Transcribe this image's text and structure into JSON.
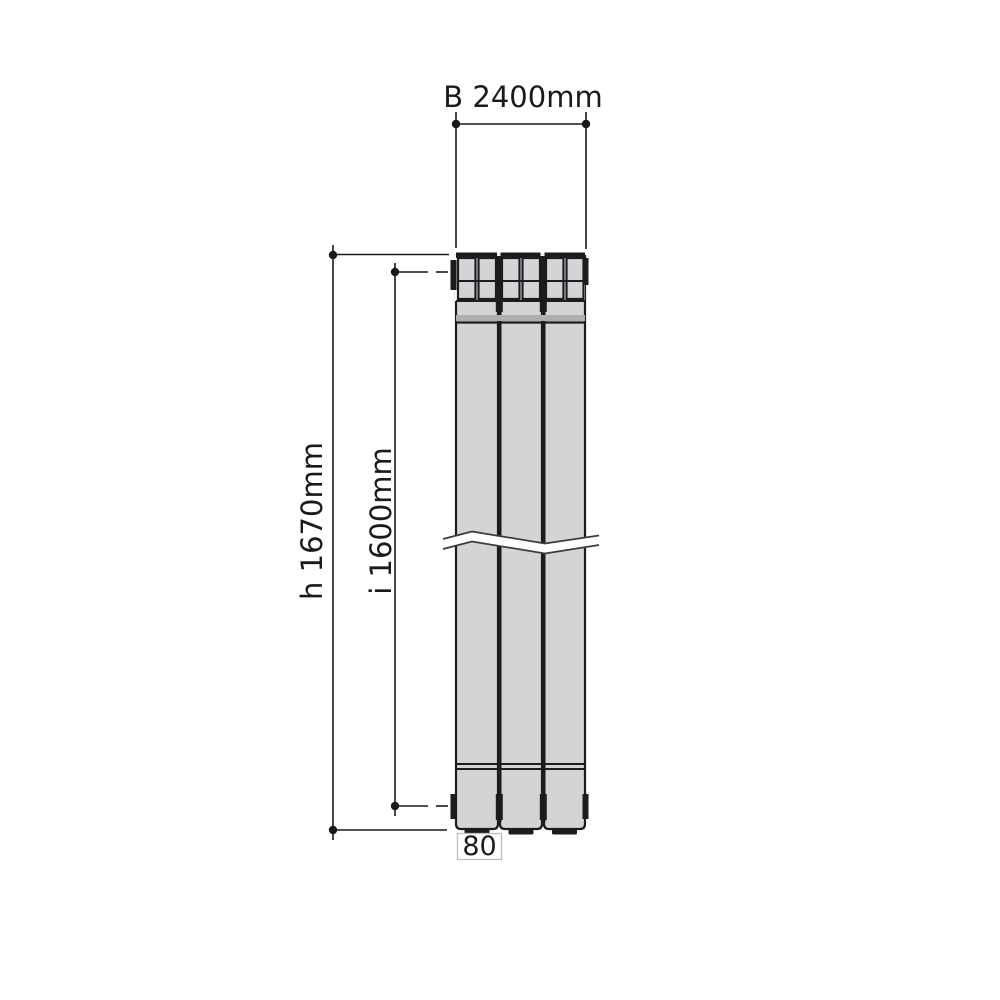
{
  "labels": {
    "width": "B 2400mm",
    "height": "h 1670mm",
    "inner_height": "i 1600mm",
    "section_width": "80"
  },
  "colors": {
    "background": "#ffffff",
    "body_fill": "#d3d4d6",
    "shade_strip": "#aeafb1",
    "outline_dark": "#1c1c1e",
    "break_line": "#3c3c3e",
    "dimension": "#1a1a1a",
    "label_box_border": "#bdbdbd"
  }
}
